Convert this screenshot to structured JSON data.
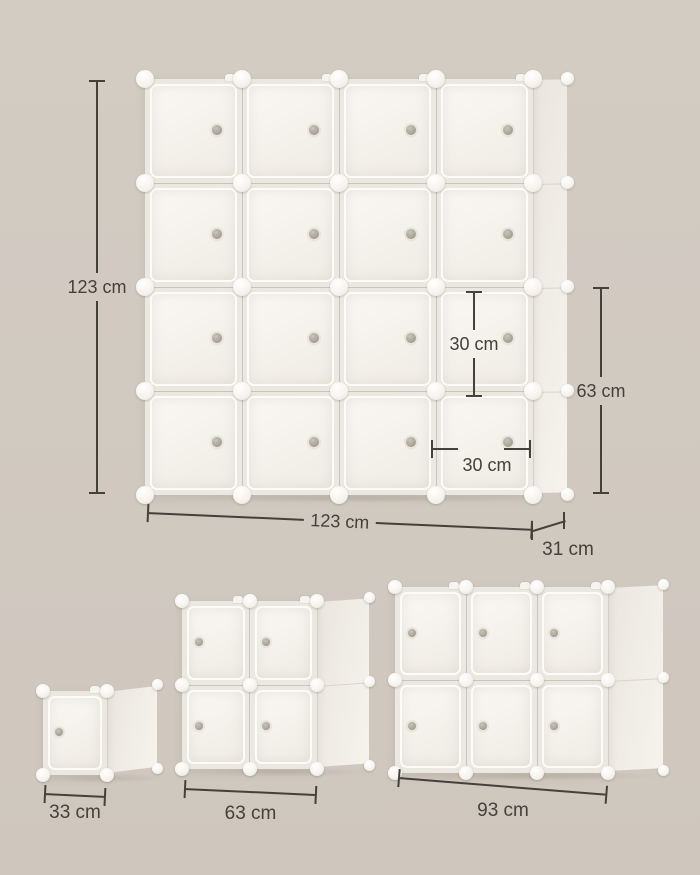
{
  "image_type": "product-dimension-diagram",
  "subject": "modular cube storage organizer",
  "colors": {
    "background": "#d1c9c0",
    "dimension_line": "#44403a",
    "cabinet_white": "#f6f3ee",
    "knob_gray": "#958e83"
  },
  "labels": {
    "big_height": "123 cm",
    "big_width": "123 cm",
    "big_depth": "31 cm",
    "right_height": "63 cm",
    "cube_height": "30 cm",
    "cube_width": "30 cm",
    "small_width": "33 cm",
    "medium_width": "63 cm",
    "large_width": "93 cm"
  },
  "units": [
    {
      "id": "big",
      "name": "cube-organizer-4x4",
      "cols": 4,
      "rows": 4,
      "cubes": 16,
      "knob_side": "right",
      "dimensions": {
        "height": "123 cm",
        "width": "123 cm",
        "depth": "31 cm",
        "cube_height": "30 cm",
        "cube_width": "30 cm",
        "two_row_height": "63 cm"
      }
    },
    {
      "id": "u33",
      "name": "cube-organizer-1x1",
      "cols": 1,
      "rows": 1,
      "cubes": 1,
      "knob_side": "left",
      "dimensions": {
        "width": "33 cm"
      }
    },
    {
      "id": "u63",
      "name": "cube-organizer-2x2",
      "cols": 2,
      "rows": 2,
      "cubes": 4,
      "knob_side": "left",
      "dimensions": {
        "width": "63 cm"
      }
    },
    {
      "id": "u93",
      "name": "cube-organizer-3x2",
      "cols": 3,
      "rows": 2,
      "cubes": 6,
      "knob_side": "left",
      "dimensions": {
        "width": "93 cm"
      }
    }
  ]
}
